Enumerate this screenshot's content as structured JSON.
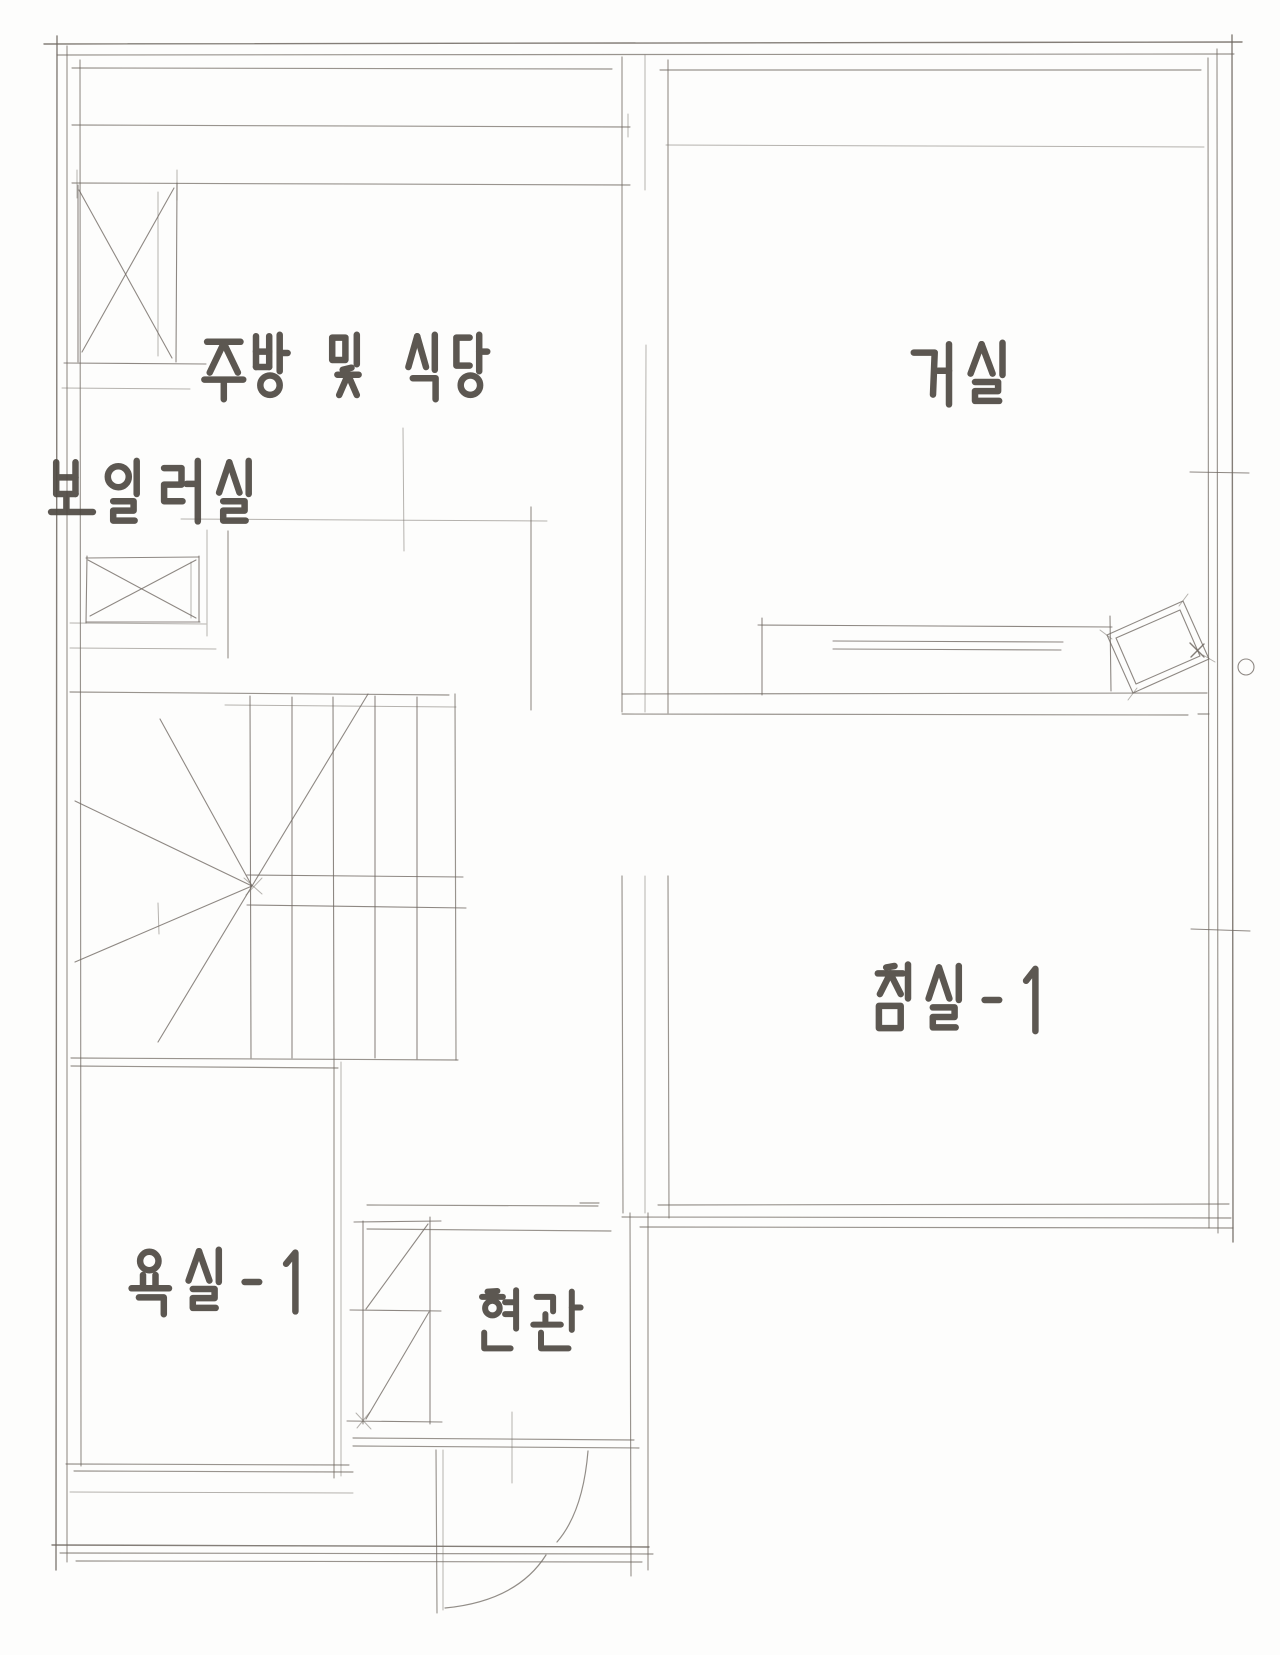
{
  "document": {
    "kind": "hand-drawn floor plan sketch",
    "floor_shape": "L-shaped single floor unit"
  },
  "colors": {
    "background": "#fdfdfc",
    "wall_line": "#6e6760",
    "label_text": "#4f4a43"
  },
  "rooms": [
    {
      "id": "kitchen-dining",
      "label": "주방 및 식당",
      "label_center": {
        "x": 348,
        "y": 367
      },
      "glyph": {
        "w": 44,
        "h": 70
      }
    },
    {
      "id": "living-room",
      "label": "거실",
      "label_center": {
        "x": 962,
        "y": 375
      },
      "glyph": {
        "w": 55,
        "h": 70
      }
    },
    {
      "id": "boiler-room",
      "label": "보일러실",
      "label_center": {
        "x": 156,
        "y": 494
      },
      "glyph": {
        "w": 51,
        "h": 72
      }
    },
    {
      "id": "bedroom-1",
      "label": "침실-1",
      "label_center": {
        "x": 953,
        "y": 1000
      },
      "glyph": {
        "w": 52,
        "h": 74
      }
    },
    {
      "id": "bathroom-1",
      "label": "욕실-1",
      "label_center": {
        "x": 213,
        "y": 1282
      },
      "glyph": {
        "w": 52,
        "h": 70
      }
    },
    {
      "id": "entrance",
      "label": "현관",
      "label_center": {
        "x": 528,
        "y": 1322
      },
      "glyph": {
        "w": 55,
        "h": 66
      }
    }
  ],
  "fixtures": [
    {
      "id": "refrigerator-x-box",
      "room": "kitchen-dining"
    },
    {
      "id": "counter-lines",
      "room": "kitchen-dining"
    },
    {
      "id": "boiler-x-box",
      "room": "boiler-room"
    },
    {
      "id": "winder-staircase",
      "room": "hall"
    },
    {
      "id": "sofa-bench",
      "room": "living-room"
    },
    {
      "id": "tilted-side-table",
      "room": "living-room"
    },
    {
      "id": "door-knob-circle",
      "room": "living-room"
    },
    {
      "id": "window-sill-ticks",
      "room": "living-room"
    },
    {
      "id": "shoe-cabinet",
      "room": "entrance"
    },
    {
      "id": "entry-door-swing-arc",
      "room": "entrance"
    },
    {
      "id": "foyer-door-swing-arc",
      "room": "entrance"
    }
  ]
}
